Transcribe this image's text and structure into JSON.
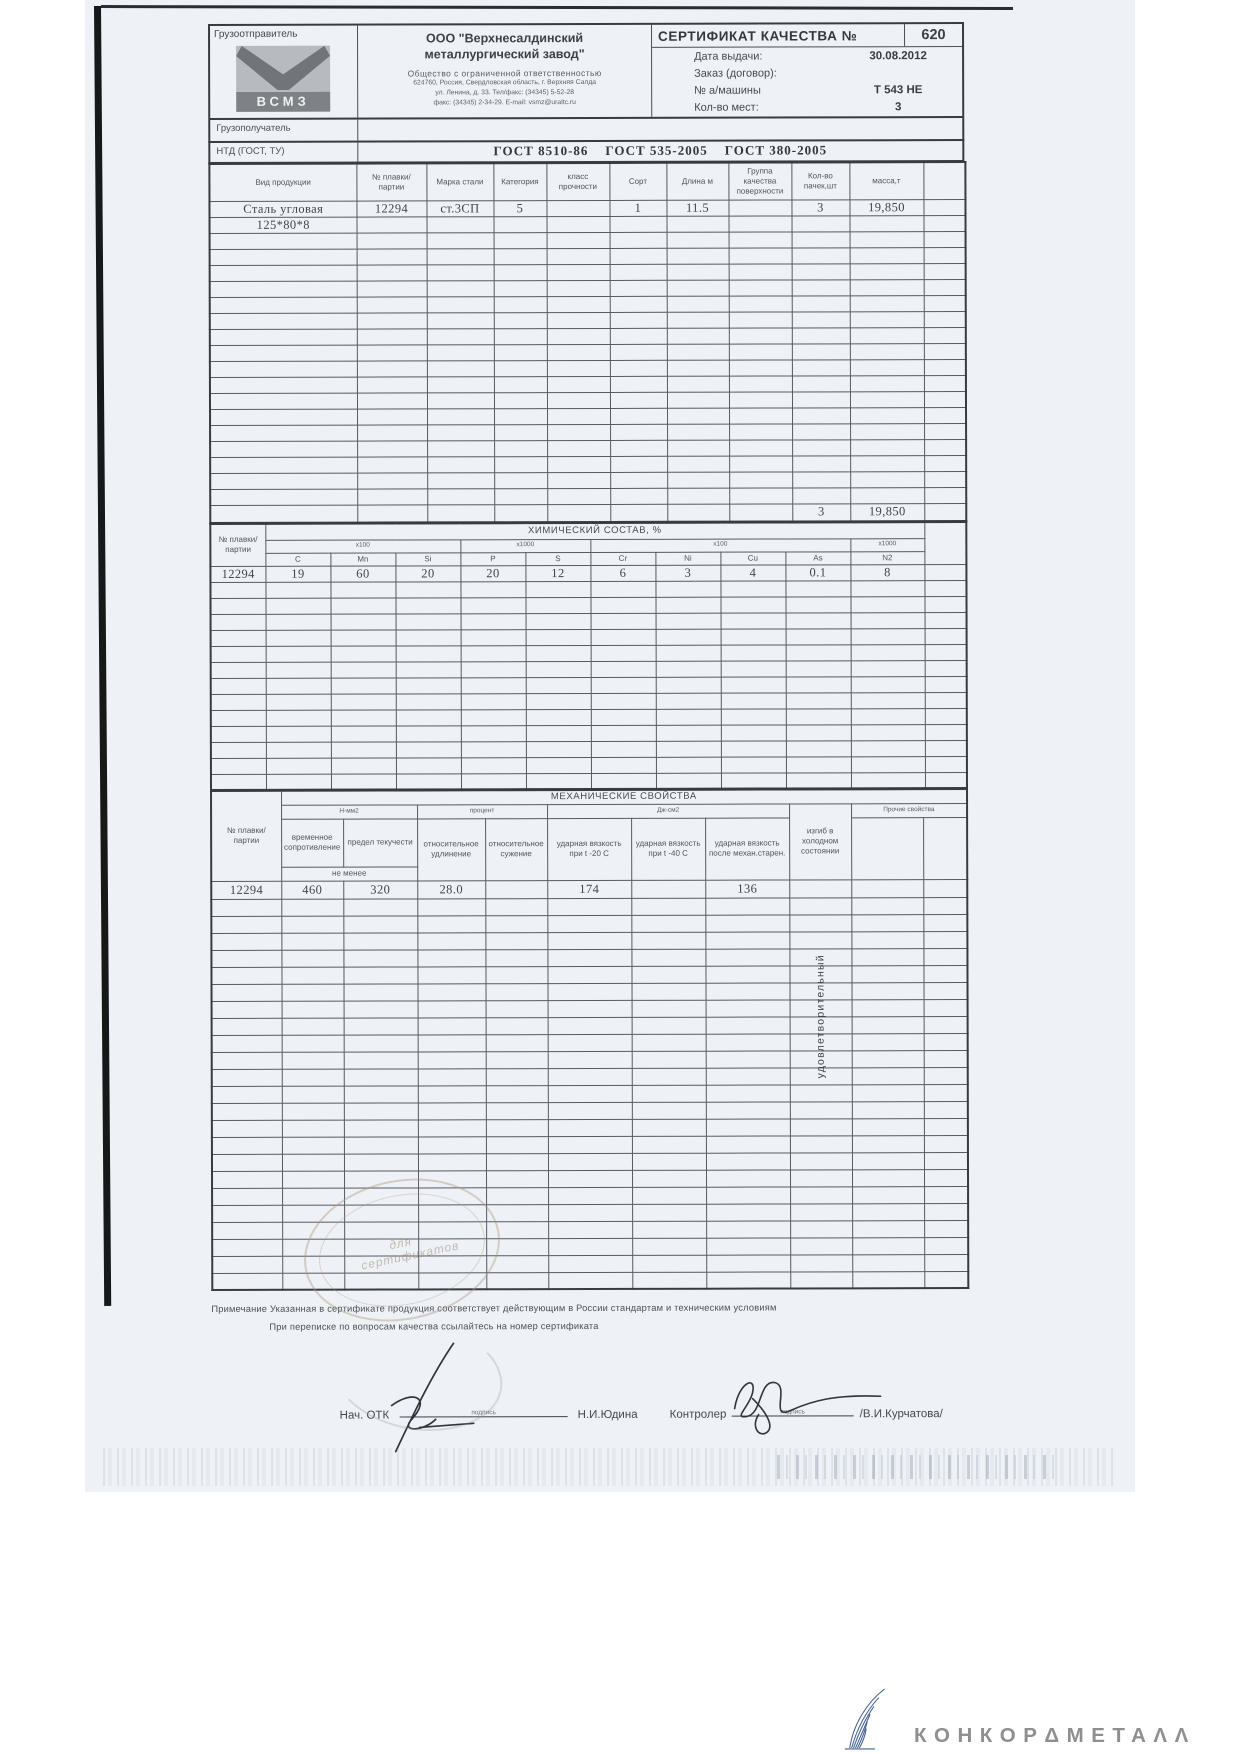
{
  "colors": {
    "paper": "#eef1f5",
    "ink": "#3a3f45",
    "table_line": "#565b62",
    "brand_gray": "#8f8f8f",
    "brand_blue": "#44618f",
    "stamp": "#a58d76"
  },
  "header": {
    "shipper_label": "Грузоотправитель",
    "logo_text": "ВСМЗ",
    "company_name_line1": "ООО \"Верхнесалдинский",
    "company_name_line2": "металлургический завод\"",
    "company_type": "Общество с ограниченной ответственностью",
    "company_addr1": "624760, Россия, Свердловская область, г. Верхняя Салда",
    "company_addr2": "ул. Ленина, д. 33. Тел/факс: (34345) 5-52-28",
    "company_addr3": "факс: (34345) 2-34-29. E-mail: vsmz@uraltc.ru",
    "cert_title": "СЕРТИФИКАТ КАЧЕСТВА №",
    "cert_number": "620",
    "issue_date_label": "Дата выдачи:",
    "issue_date_value": "30.08.2012",
    "order_label": "Заказ (договор):",
    "order_value": "",
    "truck_label": "№ а/машины",
    "truck_value": "Т 543 НЕ",
    "places_label": "Кол-во мест:",
    "places_value": "3",
    "consignee_label": "Грузополучатель",
    "ntd_label": "НТД (ГОСТ, ТУ)",
    "ntd_value": "ГОСТ 8510-86    ГОСТ 535-2005    ГОСТ 380-2005"
  },
  "main_table": {
    "headers": [
      "Вид продукции",
      "№ плавки/ партии",
      "Марка стали",
      "Категория",
      "класс прочности",
      "Сорт",
      "Длина м",
      "Группа качества поверхности",
      "Кол-во пачек,шт",
      "масса,т"
    ],
    "row1": [
      "Сталь угловая",
      "12294",
      "ст.3СП",
      "5",
      "",
      "1",
      "11.5",
      "",
      "3",
      "19,850"
    ],
    "row2": [
      "125*80*8",
      "",
      "",
      "",
      "",
      "",
      "",
      "",
      "",
      ""
    ],
    "total_packs": "3",
    "total_mass": "19,850"
  },
  "chem_table": {
    "heat_header": "№ плавки/ партии",
    "title": "ХИМИЧЕСКИЙ СОСТАВ, %",
    "multipliers": [
      "x100",
      "x1000",
      "x100",
      "x1000"
    ],
    "elements": [
      "C",
      "Mn",
      "Si",
      "P",
      "S",
      "Cr",
      "Ni",
      "Cu",
      "As",
      "N2"
    ],
    "row": [
      "12294",
      "19",
      "60",
      "20",
      "20",
      "12",
      "6",
      "3",
      "4",
      "0.1",
      "8"
    ]
  },
  "mech_table": {
    "heat_header": "№ плавки/ партии",
    "title": "МЕХАНИЧЕСКИЕ СВОЙСТВА",
    "group_nmm2": "Н-мм2",
    "group_percent": "процент",
    "group_jcm2": "Дж-см2",
    "col_tensile": "временное сопротивление",
    "col_yield": "предел текучести",
    "not_less": "не менее",
    "col_elongation": "относительное удлинение",
    "col_contraction": "относительное сужение",
    "col_impact_minus20": "ударная вязкость при t -20  С",
    "col_impact_minus40": "ударная вязкость при t -40 С",
    "col_impact_aged": "ударная вязкость после механ.старен.",
    "col_bend": "изгиб в холодном состоянии",
    "col_other": "Прочие свойства",
    "row": [
      "12294",
      "460",
      "320",
      "28.0",
      "",
      "174",
      "",
      "136"
    ],
    "bend_result": "удовлетворительный"
  },
  "notes": {
    "line1": "Примечание  Указанная в сертификате продукция соответствует действующим в России стандартам и техническим условиям",
    "line2": "При переписке по вопросам качества ссылайтесь на номер сертификата"
  },
  "signatures": {
    "otk_label": "Нач. ОТК",
    "sign_caption": "подпись",
    "otk_name": "Н.И.Юдина",
    "controller_label": "Контролер",
    "controller_name": "/В.И.Курчатова/"
  },
  "stamp_text": "для сертификатов",
  "footer_logo_text": "КОНКОРΔМЕТАΛΛ"
}
